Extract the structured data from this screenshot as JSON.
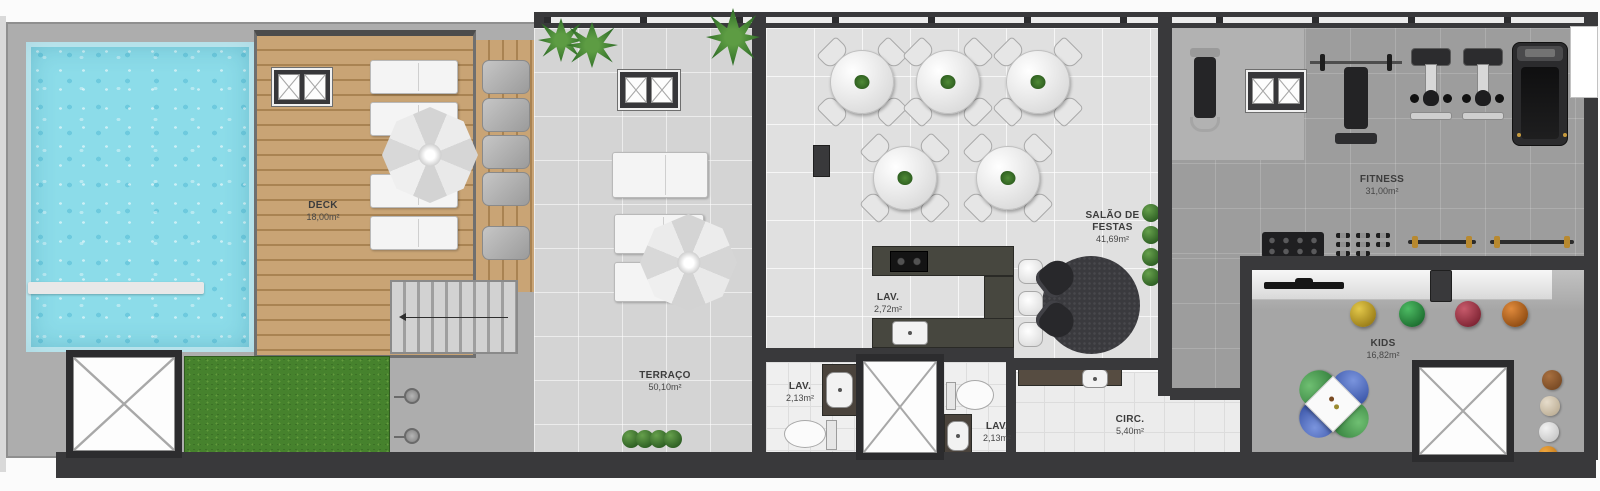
{
  "rooms": {
    "deck": {
      "name": "DECK",
      "area": "18,00m²"
    },
    "terraco": {
      "name": "TERRAÇO",
      "area": "50,10m²"
    },
    "salao_de_festas": {
      "name": "SALÃO DE\nFESTAS",
      "area": "41,69m²"
    },
    "lav_salao": {
      "name": "LAV.",
      "area": "2,72m²"
    },
    "lav_esquerdo": {
      "name": "LAV.",
      "area": "2,13m²"
    },
    "lav_direito": {
      "name": "LAV.",
      "area": "2,13m²"
    },
    "circulacao": {
      "name": "CIRC.",
      "area": "5,40m²"
    },
    "fitness": {
      "name": "FITNESS",
      "area": "31,00m²"
    },
    "kids": {
      "name": "KIDS",
      "area": "16,82m²"
    }
  },
  "colors": {
    "wall": "#39393b",
    "pool_water": "#8cdce9",
    "deck_wood": "#c9a475",
    "grass": "#46822d",
    "terrace_floor": "#d4d4d4",
    "salon_floor": "#e0e0e0",
    "fitness_floor": "#9d9d9d",
    "kids_floor": "#a6a6a6",
    "label_text": "#3c3c3c",
    "pouf_yellow": "#c4a12d",
    "pouf_green": "#35984a",
    "pouf_red": "#a93c50",
    "pouf_orange": "#c2702a",
    "kids_chair_green": "#4f9e58",
    "kids_chair_blue": "#4a66b8",
    "barbell_gold": "#b8892f"
  }
}
